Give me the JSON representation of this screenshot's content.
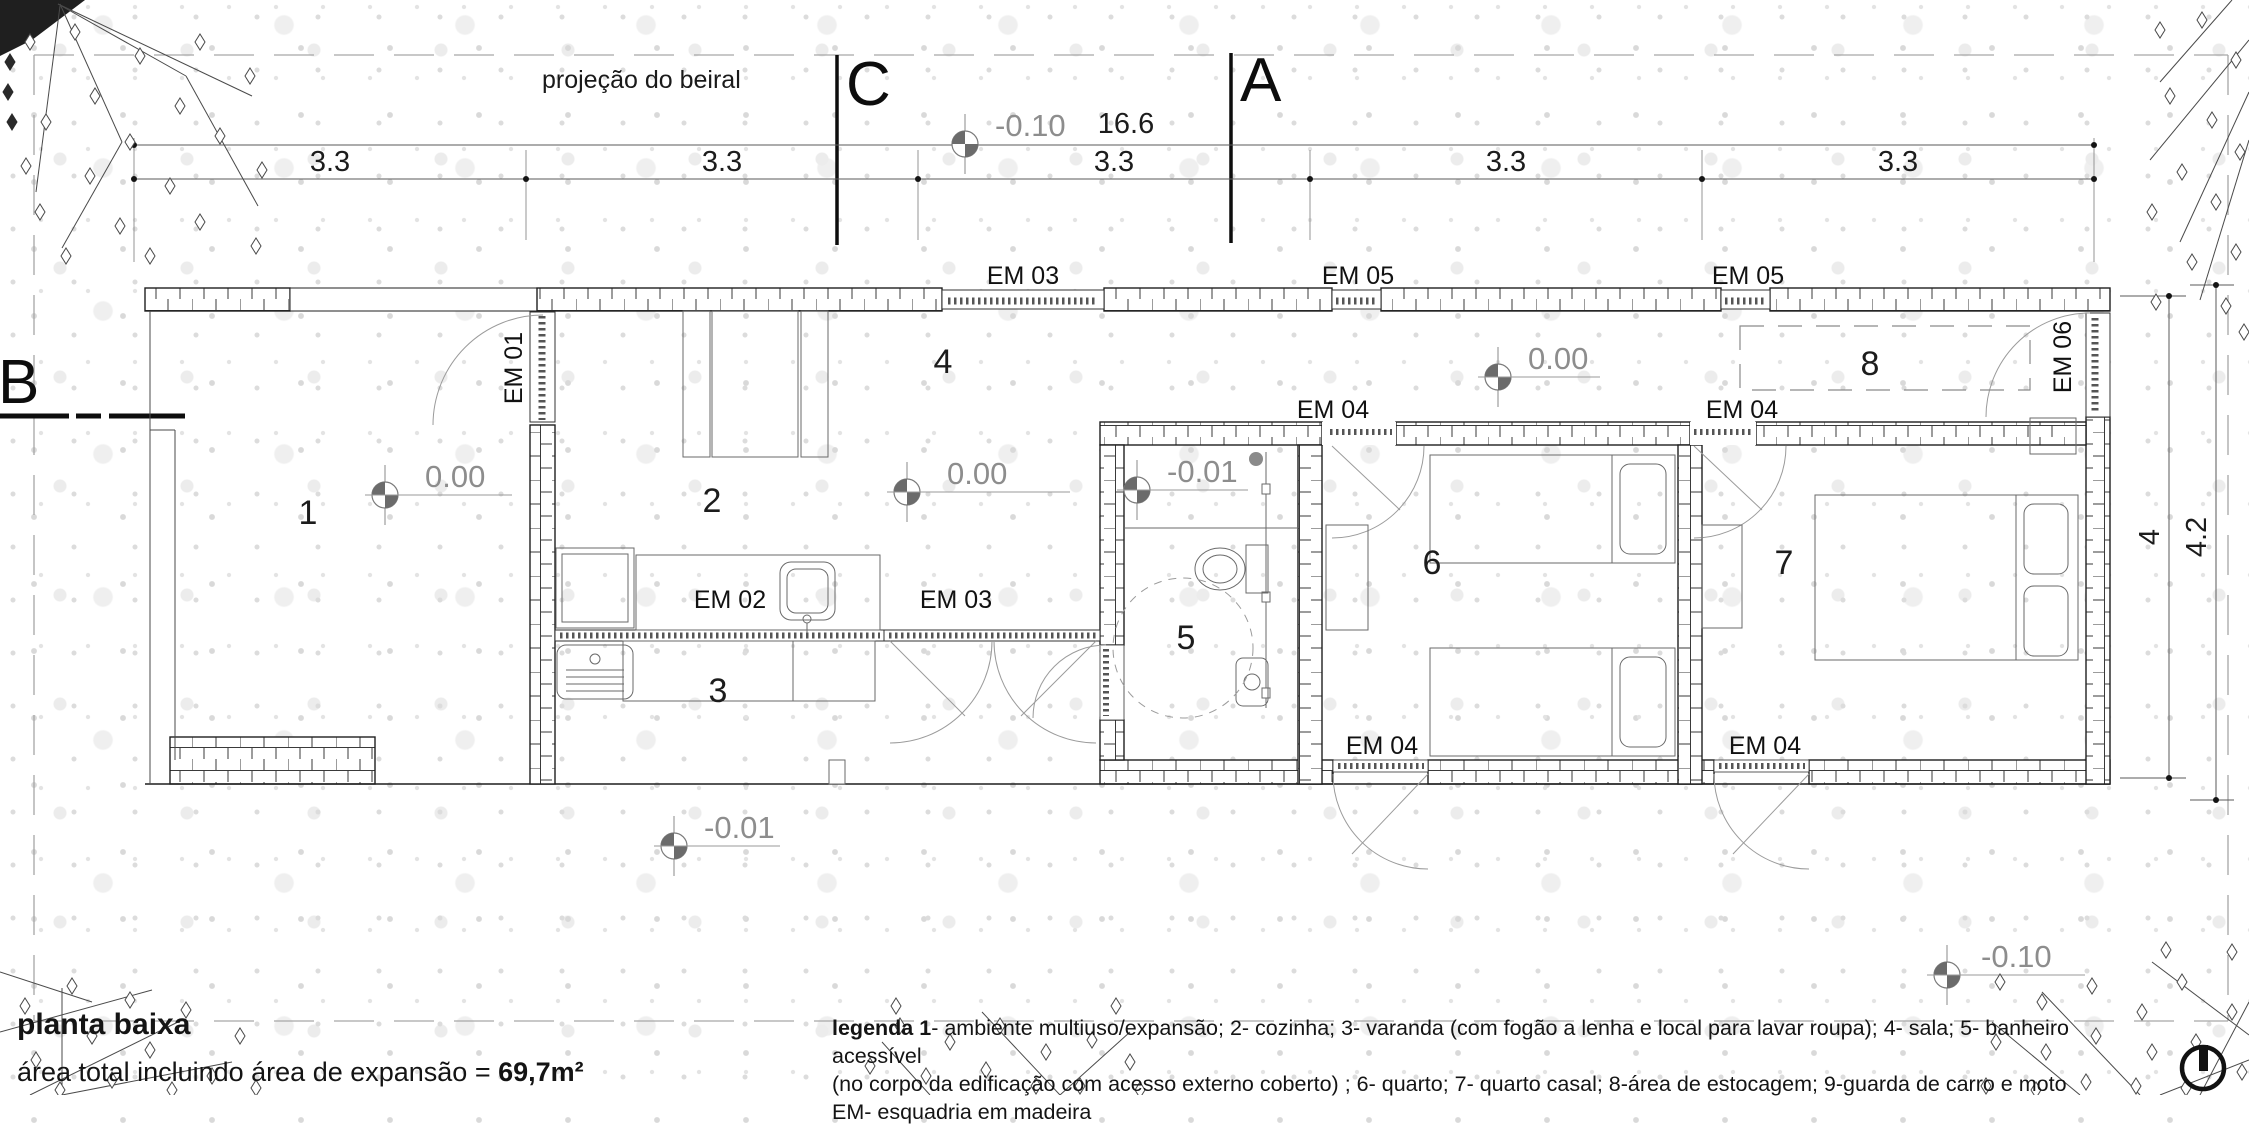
{
  "drawing": {
    "eave_label": "projeção do beiral",
    "sections": {
      "a": "A",
      "b": "B",
      "c": "C"
    },
    "dimensions": {
      "total_width": "16.6",
      "width_segments": [
        "3.3",
        "3.3",
        "3.3",
        "3.3",
        "3.3"
      ],
      "inner_height": "4",
      "outer_height": "4.2"
    },
    "levels": {
      "site_top": "-0.10",
      "room1": "0.00",
      "living": "0.00",
      "bathroom": "-0.01",
      "bedroom_hall": "0.00",
      "veranda_front": "-0.01",
      "site_bottom": "-0.10"
    },
    "room_numbers": {
      "r1": "1",
      "r2": "2",
      "r3": "3",
      "r4": "4",
      "r5": "5",
      "r6": "6",
      "r7": "7",
      "r8": "8"
    },
    "openings": {
      "em01": "EM 01",
      "em02": "EM 02",
      "em03": [
        "EM 03",
        "EM 03"
      ],
      "em04": [
        "EM 04",
        "EM 04",
        "EM 04",
        "EM 04"
      ],
      "em05": [
        "EM 05",
        "EM 05"
      ],
      "em06": "EM 06"
    }
  },
  "title_block": {
    "title": "planta baixa",
    "area_label": "área total incluindo área de expansão = ",
    "area_value": "69,7m²",
    "legend_bold": "legenda 1",
    "legend_line1_rest": "- ambiente multiuso/expansão; 2- cozinha; 3- varanda (com fogão a lenha e local para lavar roupa); 4- sala; 5- banheiro acessível",
    "legend_line2": "(no corpo da edificação com acesso externo coberto) ; 6- quarto; 7- quarto casal; 8-área de estocagem; 9-guarda de carro e moto",
    "legend_line3": "EM- esquadria em madeira"
  },
  "colors": {
    "line": "#1f1f1f",
    "annotation_gray": "#8d8d8d",
    "dim_line": "#555555",
    "eave_dash": "#a6a6a6"
  }
}
